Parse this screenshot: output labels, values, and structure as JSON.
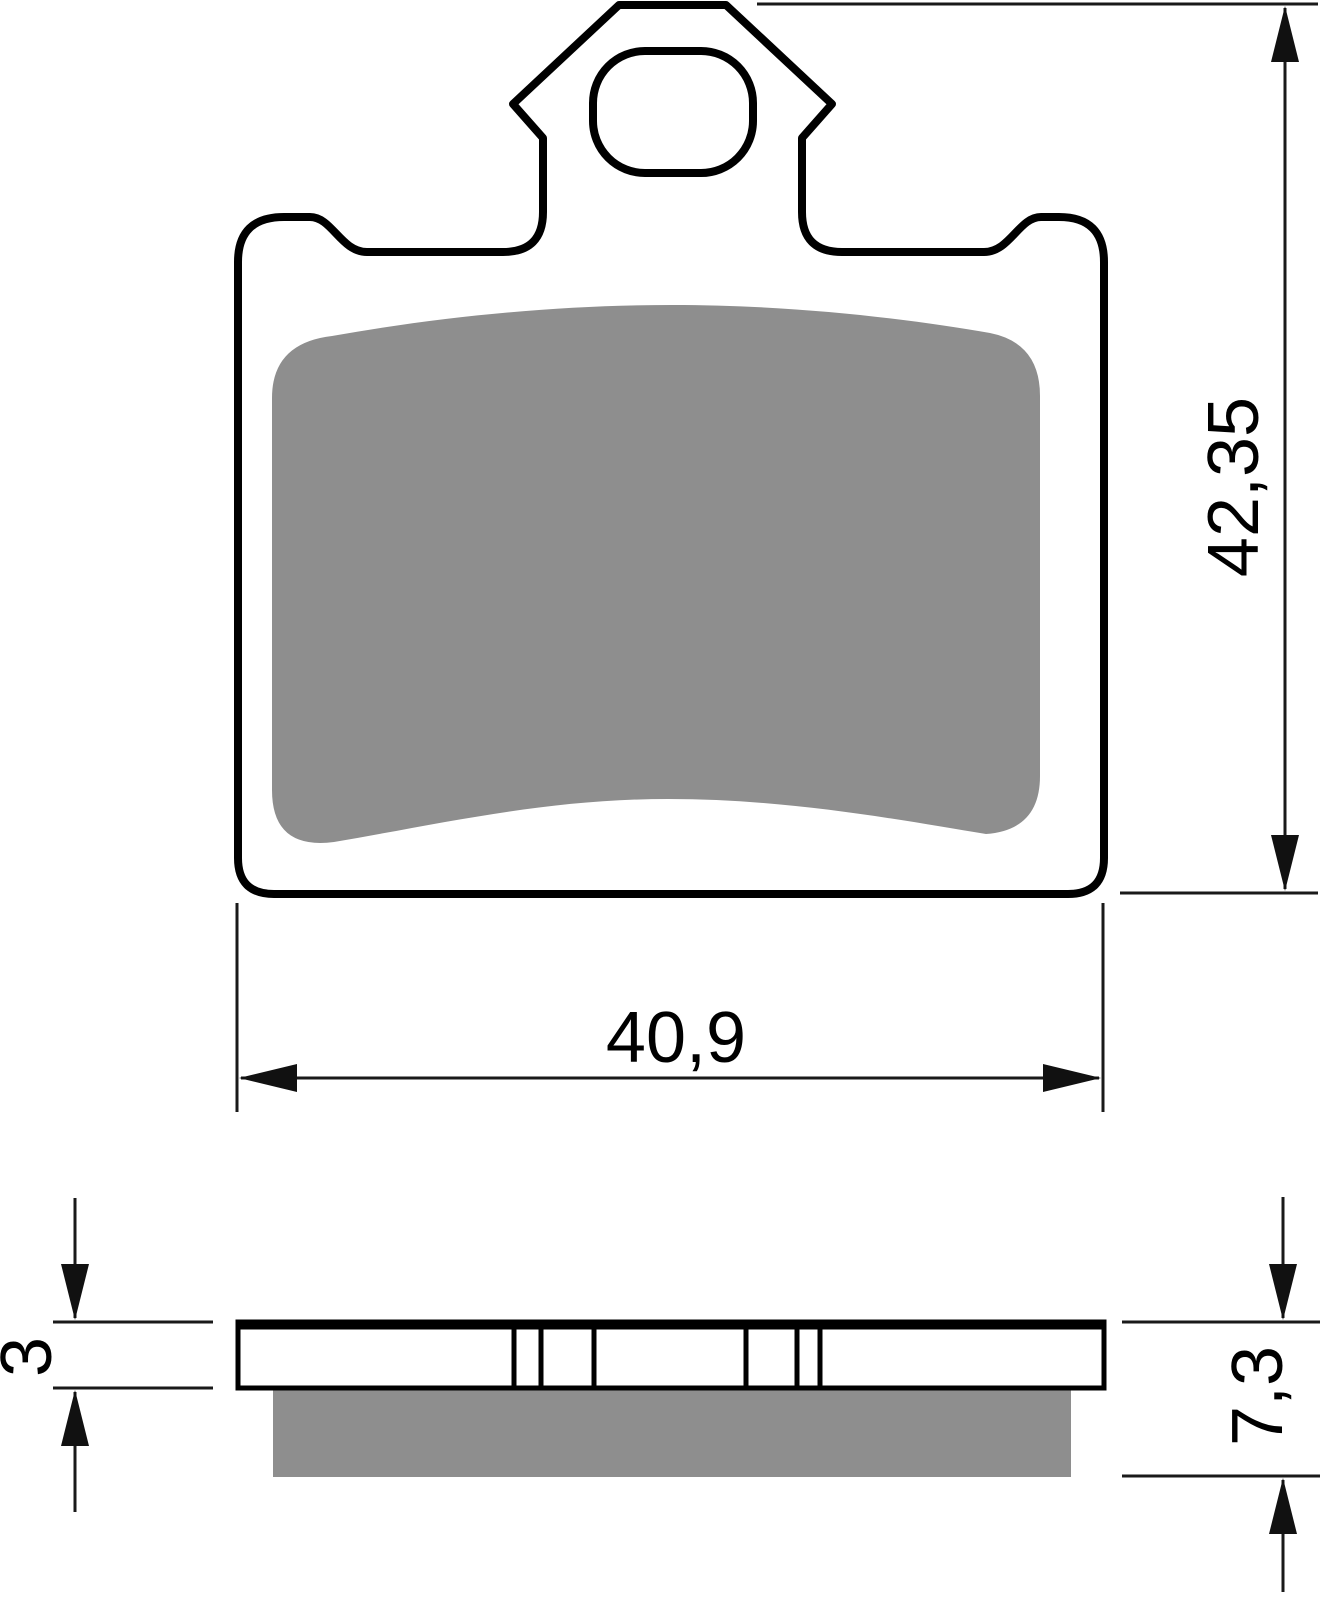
{
  "drawing": {
    "type": "technical-drawing",
    "part": "brake-pad",
    "views": {
      "front": "front-view-with-backplate-tab-and-friction-pad",
      "side": "side-profile-with-backplate-and-friction-layer"
    },
    "colors": {
      "outline": "#000000",
      "friction_material": "#8e8e8e",
      "dimension_lines": "#1a1a1a",
      "background": "#ffffff"
    },
    "dimensions": {
      "overall_height": "42,35",
      "overall_width": "40,9",
      "backplate_thickness": "3",
      "total_thickness": "7,3"
    }
  }
}
